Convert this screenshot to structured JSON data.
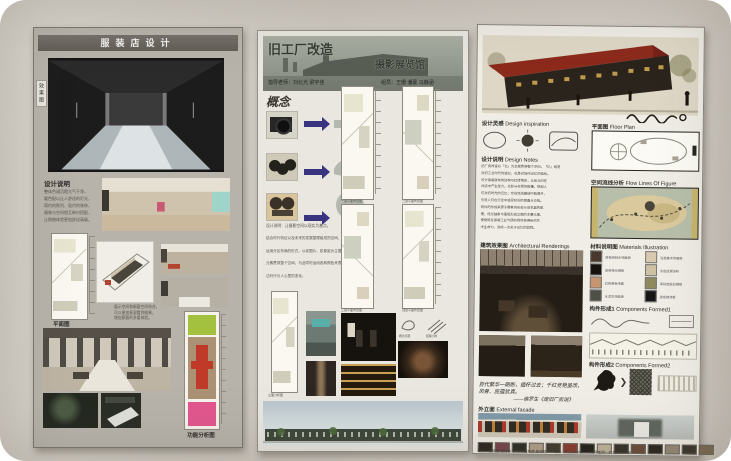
{
  "colors": {
    "wall": "#d0ccc4",
    "left_board": "#b7b3ab",
    "poster_paper": "#efede6",
    "roof_red": "#8c2a1c",
    "arrow_blue": "#3a3480",
    "func_green": "#a3c13f",
    "func_brown": "#ab9274",
    "func_red": "#c03a2a",
    "func_pink": "#e2578e",
    "sky": "#c2cdd2",
    "building_green": "#3c463a"
  },
  "left_board": {
    "title": "服装店设计",
    "side_label": "效果图",
    "design_notes_heading": "设计说明",
    "design_notes_lines": [
      "整体色调沉稳大气干净，",
      "暖色配以让人舒适的灯光，",
      "简约的陈列、现代的装饰，",
      "服装与空间相互映衬搭配，",
      "让购物体验更加舒适高级。"
    ],
    "spatial_lines": [
      "展示空间和橱窗空间结合，",
      "可以更加直观看到效果，",
      "增加顾客的多重体验。"
    ],
    "plan_label": "平面图",
    "function_label": "功能分析图"
  },
  "middle_board": {
    "title": "旧工厂改造",
    "subtitle": "摄影展览馆",
    "advisors": "指导老师：刘北光 梁宇佳",
    "members": "组员：王珊 潘蒙 马静涵",
    "concept_heading": "概念",
    "concept_note": "设计说明：让摄影空间以现实为基点，",
    "desc_lines": [
      "结合时代特征以及未来的发展整理组成的空间，",
      "运用分区布局的形式，以老图片、胶卷纸为主要",
      "元素贯穿整个空间，与此同时运用各种颜色来表",
      "达时代与人心里的变化。"
    ],
    "plan_captions": [
      "一层平面布置图",
      "二层平面布置图",
      "三层平面布置图",
      "顶层平面布置图",
      "立面分析图"
    ],
    "sketch_captions": [
      "概念草图",
      "肌理小样"
    ]
  },
  "right_board": {
    "sections": {
      "inspiration": {
        "cn": "设计灵感",
        "en": "Design inspiration"
      },
      "floor_plan": {
        "cn": "平面图",
        "en": "Floor Plan"
      },
      "notes": {
        "cn": "设计说明",
        "en": "Design Notes"
      },
      "flow": {
        "cn": "空间流线分析",
        "en": "Flow Lines Of Figure"
      },
      "renderings": {
        "cn": "建筑效果图",
        "en": "Architectural Renderings"
      },
      "materials": {
        "cn": "材料说明图",
        "en": "Materials Illustration"
      },
      "comp1": {
        "cn": "构件形成1",
        "en": "Components Formed1"
      },
      "comp2": {
        "cn": "构件形成2",
        "en": "Components Formed2"
      },
      "facade": {
        "cn": "外立面",
        "en": "External facade"
      }
    },
    "notes_lines": [
      "旧厂房改造以「忆」为主题贯穿整个空间，「忆」既是",
      "对旧工业时代的追忆，也是对场所记忆的延续。",
      "设计保留原有的结构与红砖墙体，让新与旧在",
      "对话中产生张力。光影与材质的碰撞，唤起人",
      "们对旧时光的记忆；空间流线围绕中庭展开，",
      "引导人们在行走中感受时间的层叠与交错。",
      "构件的形成来源于舞者的形态与旧机器的肌",
      "理，经过抽象与重组形成立面的主要元素，",
      "使建筑在保留工业气质的同时获得新的艺",
      "术生命力，完成一次关于记忆的旅程。"
    ],
    "materials": [
      {
        "c": "#4a382c",
        "label": "深色胡桃木饰面板"
      },
      {
        "c": "#d9c9ae",
        "label": "浅色橡木饰面板"
      },
      {
        "c": "#17120e",
        "label": "黑色哑光钢板"
      },
      {
        "c": "#cec0a2",
        "label": "米色肌理涂料"
      },
      {
        "c": "#c79671",
        "label": "红砖原色饰面"
      },
      {
        "c": "#8e8a5e",
        "label": "军绿色做旧钢板"
      },
      {
        "c": "#4e4f47",
        "label": "水泥灰饰面板"
      },
      {
        "c": "#161616",
        "label": "黑色烤漆板"
      }
    ],
    "quote_line1": "百代繁华一朝断，缅怀过去；千红竞艳虽改，",
    "quote_line2": "风骨、底蕴犹真。",
    "quote_attribution": "——佛罗生《废旧厂房说》",
    "filmstrip": [
      "#2c2620",
      "#77434a",
      "#2a2e26",
      "#b0a08a",
      "#403a30",
      "#8a3a30",
      "#23201a",
      "#c0b49c",
      "#35302a",
      "#6a4a3a",
      "#2a2620",
      "#958a74",
      "#3a342c",
      "#7a6a52"
    ],
    "credits": "组员：江慧慧 张诗敏 宋丹丹 戴林萍 黄玥榆　　班级：环艺1406班　　指导老师：刘北光 梁宇佳"
  }
}
